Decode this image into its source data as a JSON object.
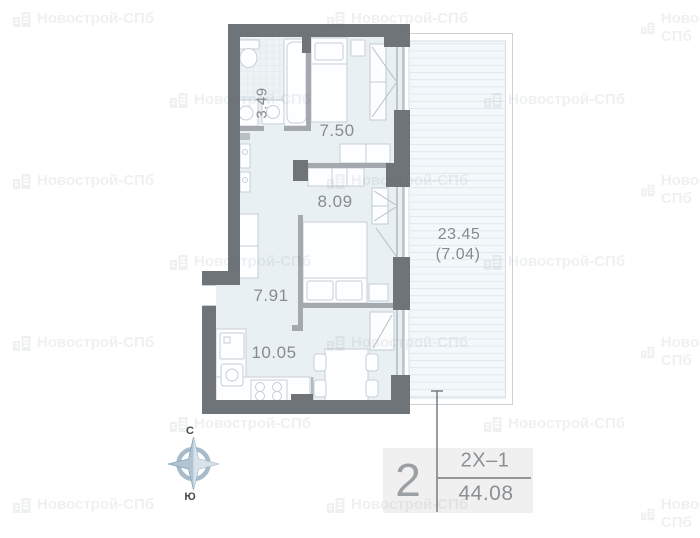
{
  "watermark": {
    "brand": "Новострой-СПб"
  },
  "plan": {
    "rooms": [
      {
        "name": "bathroom",
        "area": "3.49"
      },
      {
        "name": "bedroom-small",
        "area": "7.50"
      },
      {
        "name": "bedroom",
        "area": "8.09"
      },
      {
        "name": "hallway",
        "area": "7.91"
      },
      {
        "name": "kitchen-living",
        "area": "10.05"
      },
      {
        "name": "terrace",
        "area": "23.45",
        "area_reduced": "(7.04)"
      }
    ],
    "compass": {
      "north": "С",
      "south": "Ю"
    }
  },
  "unit_card": {
    "rooms_count": "2",
    "layout_code": "2Х–1",
    "total_area": "44.08"
  },
  "colors": {
    "wall": "#6f7478",
    "thin_wall": "#a3a9ae",
    "room_fill": "#e9f0f4",
    "terrace_fill": "#f4f8fa",
    "furniture_stroke": "#c6cfd5",
    "compass": "#a6bcca",
    "label_text": "#878b8f",
    "card_bg": "#f0f0f0"
  }
}
